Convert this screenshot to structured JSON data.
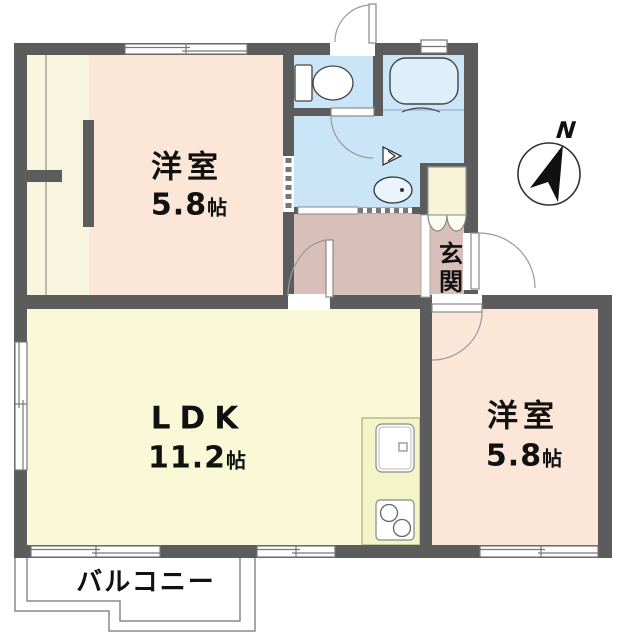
{
  "rooms": {
    "bedroom_nw": {
      "label": "洋室",
      "size": "5.8",
      "unit": "帖"
    },
    "ldk": {
      "label": "LDK",
      "size": "11.2",
      "unit": "帖"
    },
    "bedroom_se": {
      "label": "洋室",
      "size": "5.8",
      "unit": "帖"
    },
    "entrance": {
      "label": "玄関"
    },
    "balcony": {
      "label": "バルコニー"
    }
  },
  "compass": {
    "label": "N"
  },
  "colors": {
    "wall": "#5c5c5c",
    "bedroom": "#fbe6d8",
    "ldk": "#f9f8d7",
    "wet_area": "#c9e5f7",
    "bathtub": "#ddeffb",
    "hallway": "#d8bfba",
    "closet": "#f7f5dd",
    "counter": "#f3f4c8",
    "cabinet": "#f7f3d7"
  }
}
